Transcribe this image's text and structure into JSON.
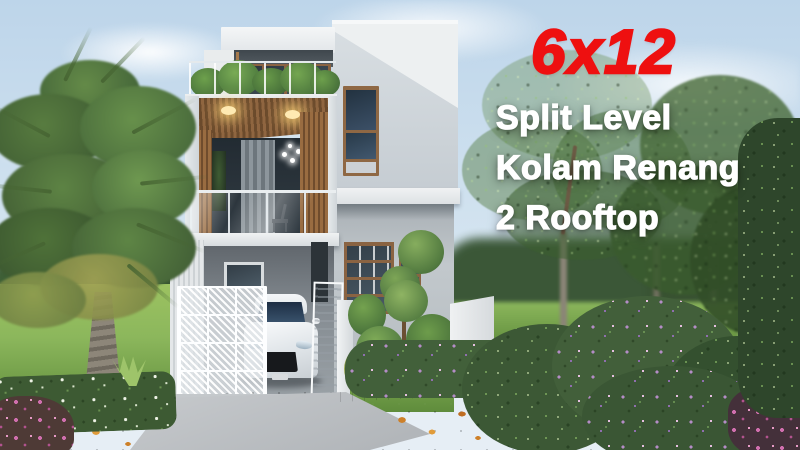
{
  "overlay": {
    "headline": "6x12",
    "lines": [
      "Split Level",
      "Kolam Renang",
      "2 Rooftop"
    ]
  },
  "palette": {
    "headline_red": "#ee1010",
    "text_white": "#ffffff",
    "sky_top": "#bdd5ea",
    "sky_mid": "#d4e4f0",
    "lawn_light": "#8cb75c",
    "lawn_dark": "#5d8a3a",
    "asphalt_dark": "#3d4145",
    "asphalt_light": "#53575c",
    "concrete": "#c0c4c7",
    "curb_grey": "#a6abae",
    "house_white": "#edf0f1",
    "house_grey": "#b8bec3",
    "wall_shadow": "#8f969b",
    "wood_light": "#996c41",
    "wood_dark": "#6f4c2d",
    "glass_dark": "#2d3a47",
    "gate_white": "#f7f9fa",
    "foliage_dark": "#33502e",
    "foliage_mid": "#4e7340",
    "foliage_light": "#6f9c4c",
    "palm_green": "#5a8142",
    "palm_yellow": "#a8a04f",
    "trunk_grey": "#847e70",
    "flower_purple": "#b48cc6",
    "flower_pink": "#d06fae",
    "flower_white": "#eef3e6",
    "leaf_orange": "#cd8029"
  }
}
